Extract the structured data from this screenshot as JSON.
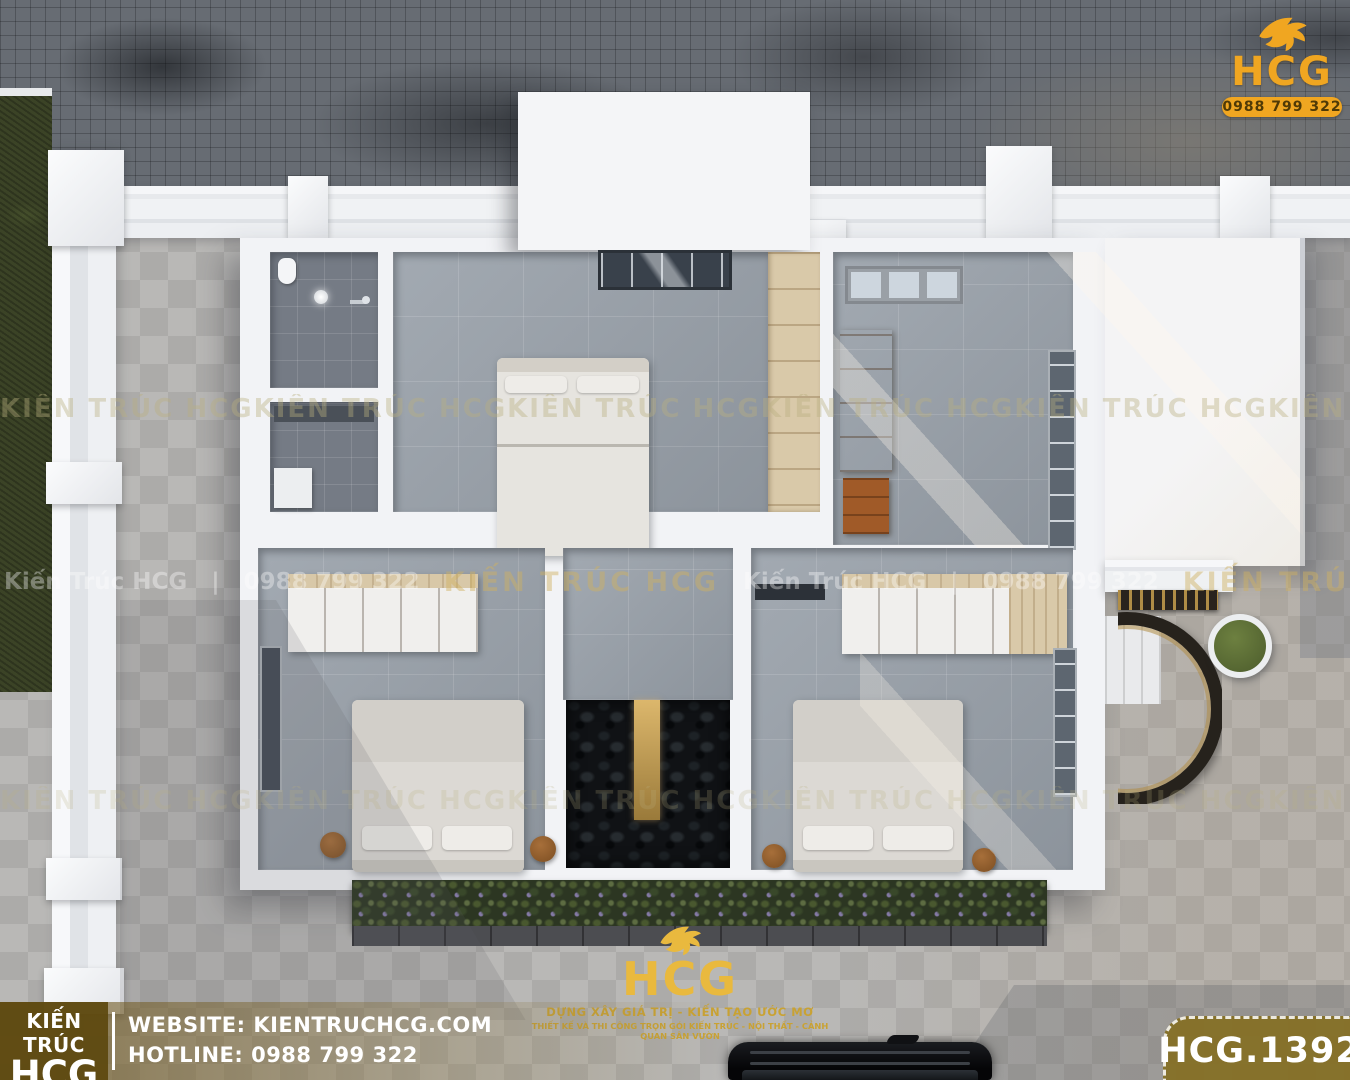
{
  "logo_top_right": {
    "brand": "HCG",
    "phone": "0988 799 322"
  },
  "logo_bottom": {
    "brand": "HCG",
    "slogan1": "DỰNG XÂY GIÁ TRỊ - KIẾN TẠO ƯỚC MƠ",
    "slogan2": "THIẾT KẾ VÀ THI CÔNG TRỌN GÓI KIẾN TRÚC - NỘI THẤT - CẢNH QUAN SÂN VƯỜN"
  },
  "footer": {
    "brand_top": "KIẾN TRÚC",
    "brand_bottom": "HCG",
    "website": "WEBSITE: KIENTRUCHCG.COM",
    "hotline": "HOTLINE: 0988 799 322"
  },
  "badge": {
    "code": "HCG.1392"
  },
  "watermarks": {
    "tile": "KIẾN TRÚC HCG",
    "band_name": "Kiến Trúc HCG",
    "band_name_caps": "KIẾN TRÚC HCG",
    "band_phone": "0988 799 322",
    "separator": "|"
  },
  "colors": {
    "brand_gold": "#F0A621",
    "footer_brown": "#5E490F",
    "badge_olive": "#857026",
    "wood_accent": "#B5662C",
    "tile_gray": "#98A0A9",
    "road_gray": "#676C73",
    "grass_green": "#3B4326"
  }
}
